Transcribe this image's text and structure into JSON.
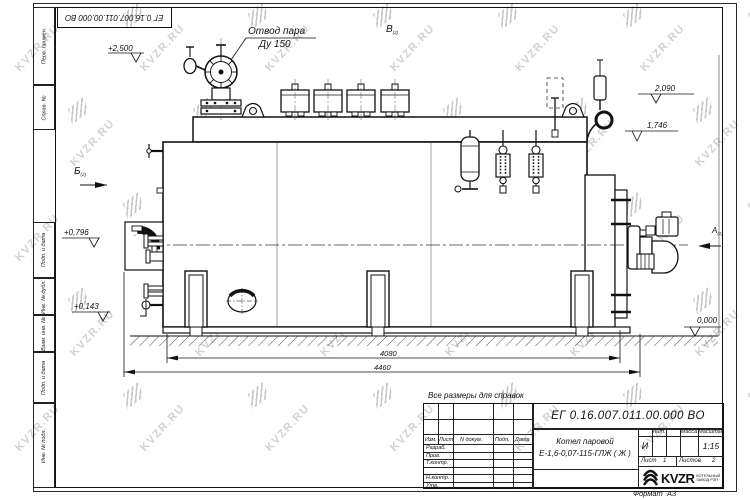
{
  "watermark": {
    "text": "KVZR.RU"
  },
  "stamp": {
    "doc_number": "ЕГ 0.16.007.011.00.000  ВО"
  },
  "margin": {
    "perv": "Перв. примен.",
    "sprav": "Справ. №",
    "podp1": "Подп. и дата",
    "inv_dubl": "Инв. № дубл.",
    "vzam": "Взам. инв. №",
    "podp2": "Подп. и дата",
    "inv_podl": "Инв. № подл."
  },
  "callout": {
    "line1": "Отвод пара",
    "line2": "Ду 150"
  },
  "views": {
    "b_top": "В",
    "b_left": "Б",
    "a_right": "А",
    "sub": "(2)"
  },
  "elevations": {
    "e2500": "+2,500",
    "e2090": "2,090",
    "e1746": "1,746",
    "e0796": "+0,796",
    "e0143": "+0,143",
    "e0000": "0,000"
  },
  "dimensions": {
    "d4080": "4080",
    "d4460": "4460"
  },
  "note": "Все размеры для справок",
  "title_block": {
    "doc_number": "ЕГ 0.16.007.011.00.000  ВО",
    "product_line1": "Котел паровой",
    "product_line2": "Е-1,6-0,07-115-ГЛЖ ( Ж )",
    "h_izm": "Изм.",
    "h_list": "Лист",
    "h_ndoc": "N докум.",
    "h_podp": "Подп.",
    "h_data": "Дата",
    "r_razrab": "Разраб.",
    "r_prov": "Пров.",
    "r_tkontr": "Т.контр.",
    "r_nkontr": "Н.контр.",
    "r_utv": "Утв.",
    "lit_label": "Лит.",
    "massa_label": "Масса",
    "masshtab_label": "Масштаб",
    "lit_value": "И",
    "masshtab_value": "1:15",
    "list_label": "Лист",
    "list_value": "1",
    "listov_label": "Листов",
    "listov_value": "2",
    "logo_word": "KVZR",
    "logo_sub1": "КОТЕЛЬНЫЙ",
    "logo_sub2": "ЗАВОД РЭП",
    "format_label": "Формат",
    "format_value": "А3"
  }
}
